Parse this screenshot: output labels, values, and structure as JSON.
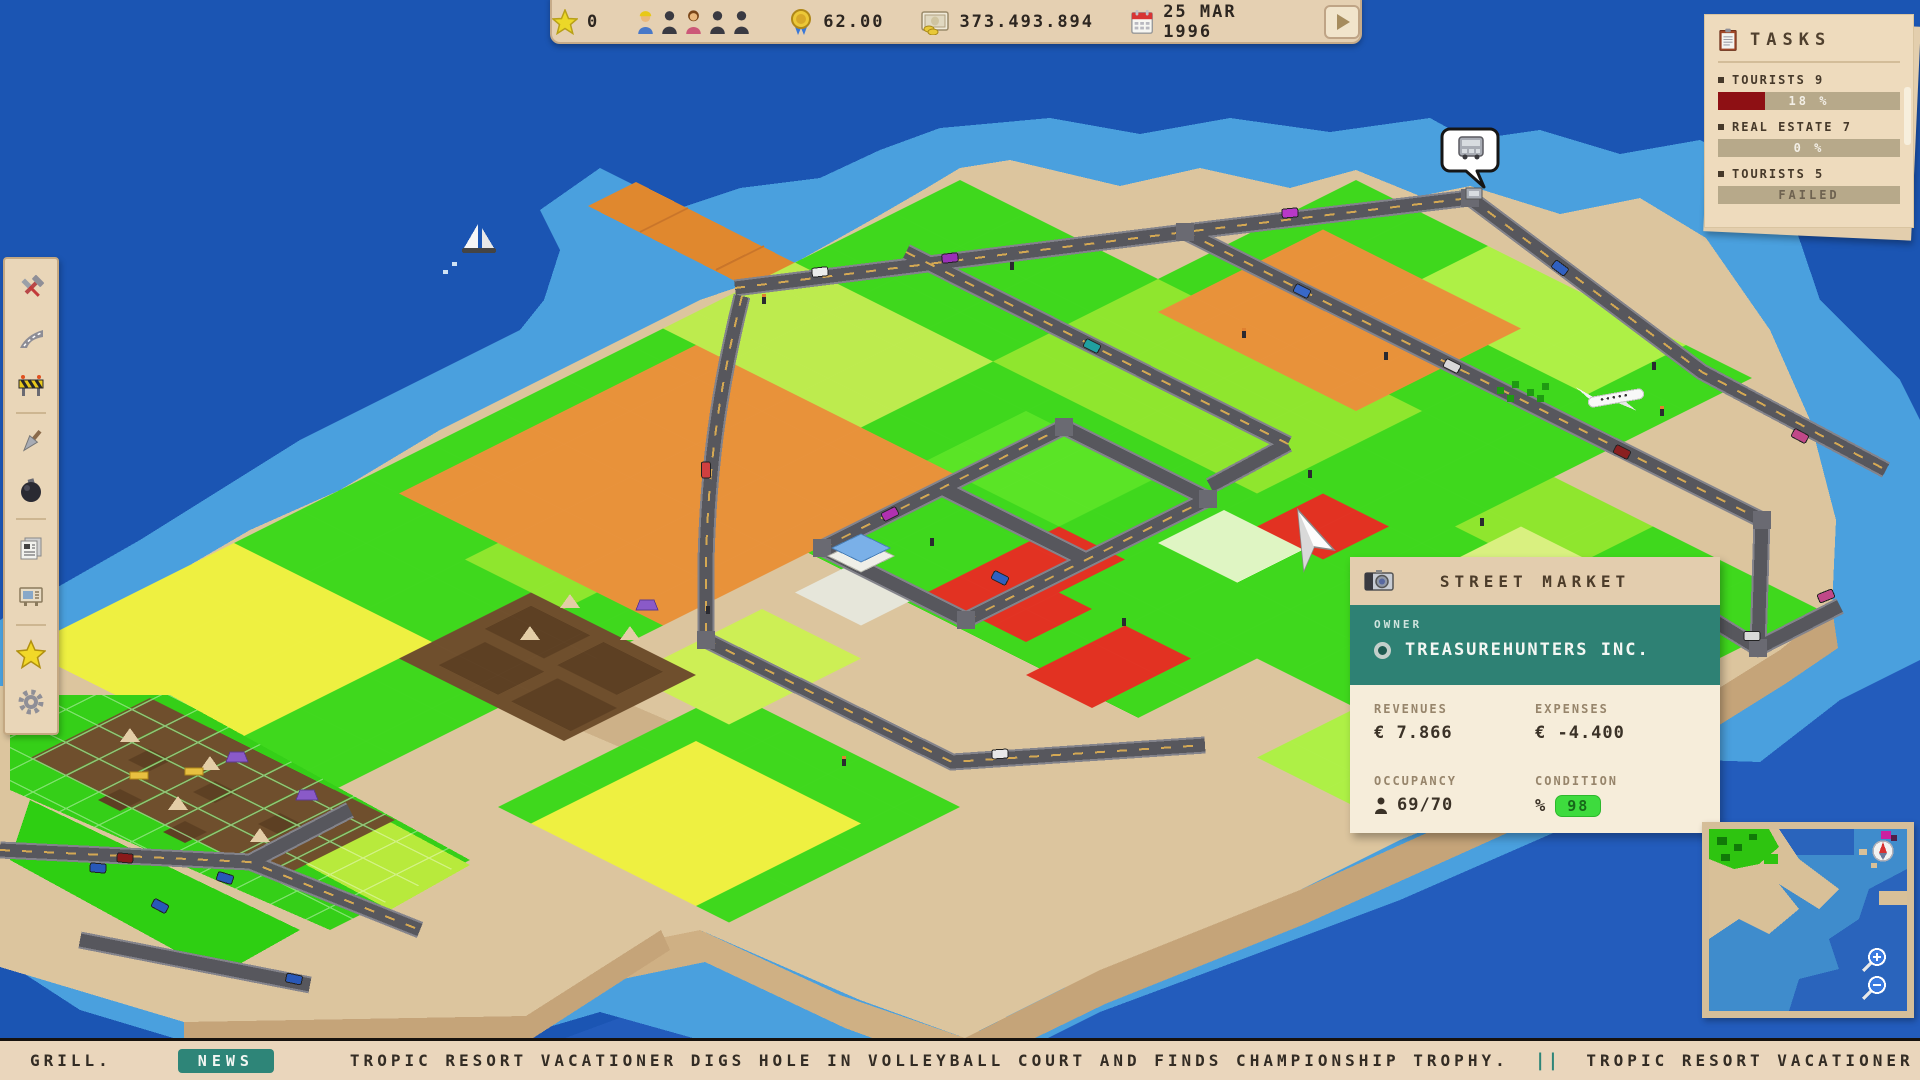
{
  "hud": {
    "star_value": "0",
    "rating_value": "62.00",
    "money_value": "373.493.894",
    "date_value": "25 MAR 1996"
  },
  "tasks": {
    "title": "TASKS",
    "items": [
      {
        "label": "TOURISTS 9",
        "value": "18 %",
        "fill_style": "width:26%"
      },
      {
        "label": "REAL ESTATE 7",
        "value": "0 %",
        "fill_style": "width:0%"
      },
      {
        "label": "TOURISTS 5",
        "value": "FAILED",
        "fill_style": "width:0%"
      }
    ]
  },
  "building": {
    "title": "STREET MARKET",
    "owner_label": "OWNER",
    "owner_name": "TREASUREHUNTERS INC.",
    "revenues_label": "REVENUES",
    "revenues_value": "€ 7.866",
    "expenses_label": "EXPENSES",
    "expenses_value": "€ -4.400",
    "occupancy_label": "OCCUPANCY",
    "occupancy_value": "69/70",
    "condition_label": "CONDITION",
    "condition_icon": "%",
    "condition_value": "98"
  },
  "toolbar": {
    "items": [
      {
        "icon": "build-tools-icon"
      },
      {
        "icon": "road-icon"
      },
      {
        "icon": "construction-barrier-icon"
      },
      {
        "icon": "shovel-icon"
      },
      {
        "icon": "demolish-bomb-icon"
      },
      {
        "icon": "newspaper-icon"
      },
      {
        "icon": "billboard-icon"
      },
      {
        "icon": "star-icon"
      },
      {
        "icon": "settings-gear-icon"
      }
    ]
  },
  "ticker": {
    "lead": "GRILL.",
    "badge": "NEWS",
    "headline": "TROPIC RESORT VACATIONER DIGS HOLE IN VOLLEYBALL COURT AND FINDS CHAMPIONSHIP TROPHY.",
    "separator": "||",
    "headline_next": "TROPIC RESORT VACATIONER DIGS HOLE IN VOLLEYBA"
  },
  "colors": {
    "panel_tan": "#e7d3b4",
    "teal": "#2e8174",
    "task_bar_fill": "#8e1014",
    "condition_badge": "#3edb3e",
    "water_deep": "#1b55b3",
    "water_shallow": "#4aa0de",
    "sand": "#dcc59e",
    "grass": "#3fd81d",
    "orange_field": "#e8923a",
    "road": "#57575d"
  }
}
